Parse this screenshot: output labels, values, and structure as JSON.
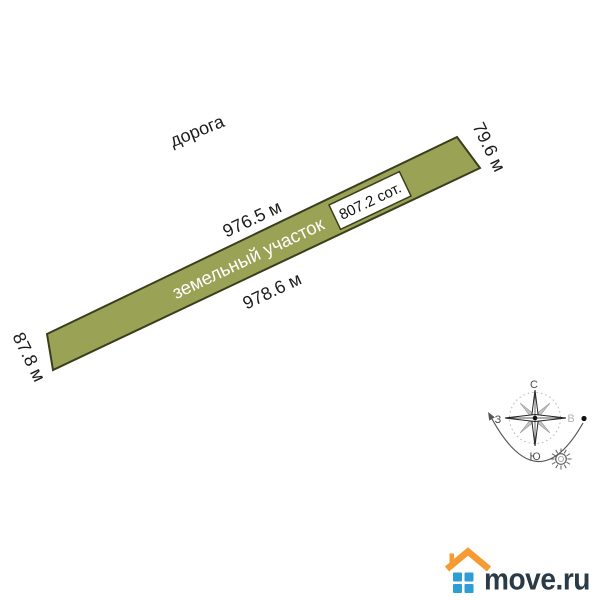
{
  "diagram": {
    "road_label": "дорога",
    "plot": {
      "label": "земельный участок",
      "area": "807.2 сот.",
      "side_top": "976.5 м",
      "side_bottom": "978.6 м",
      "side_left": "87.8 м",
      "side_right": "79.6 м",
      "fill_color": "#9aa355",
      "border_color": "#3a3e1d"
    },
    "compass": {
      "north": "С",
      "south": "Ю",
      "west": "З",
      "east": "В"
    }
  },
  "logo": {
    "text": "move.ru",
    "roof_color": "#f59b31",
    "windows_color": "#2d9ed3",
    "text_color": "#2b3a47"
  }
}
